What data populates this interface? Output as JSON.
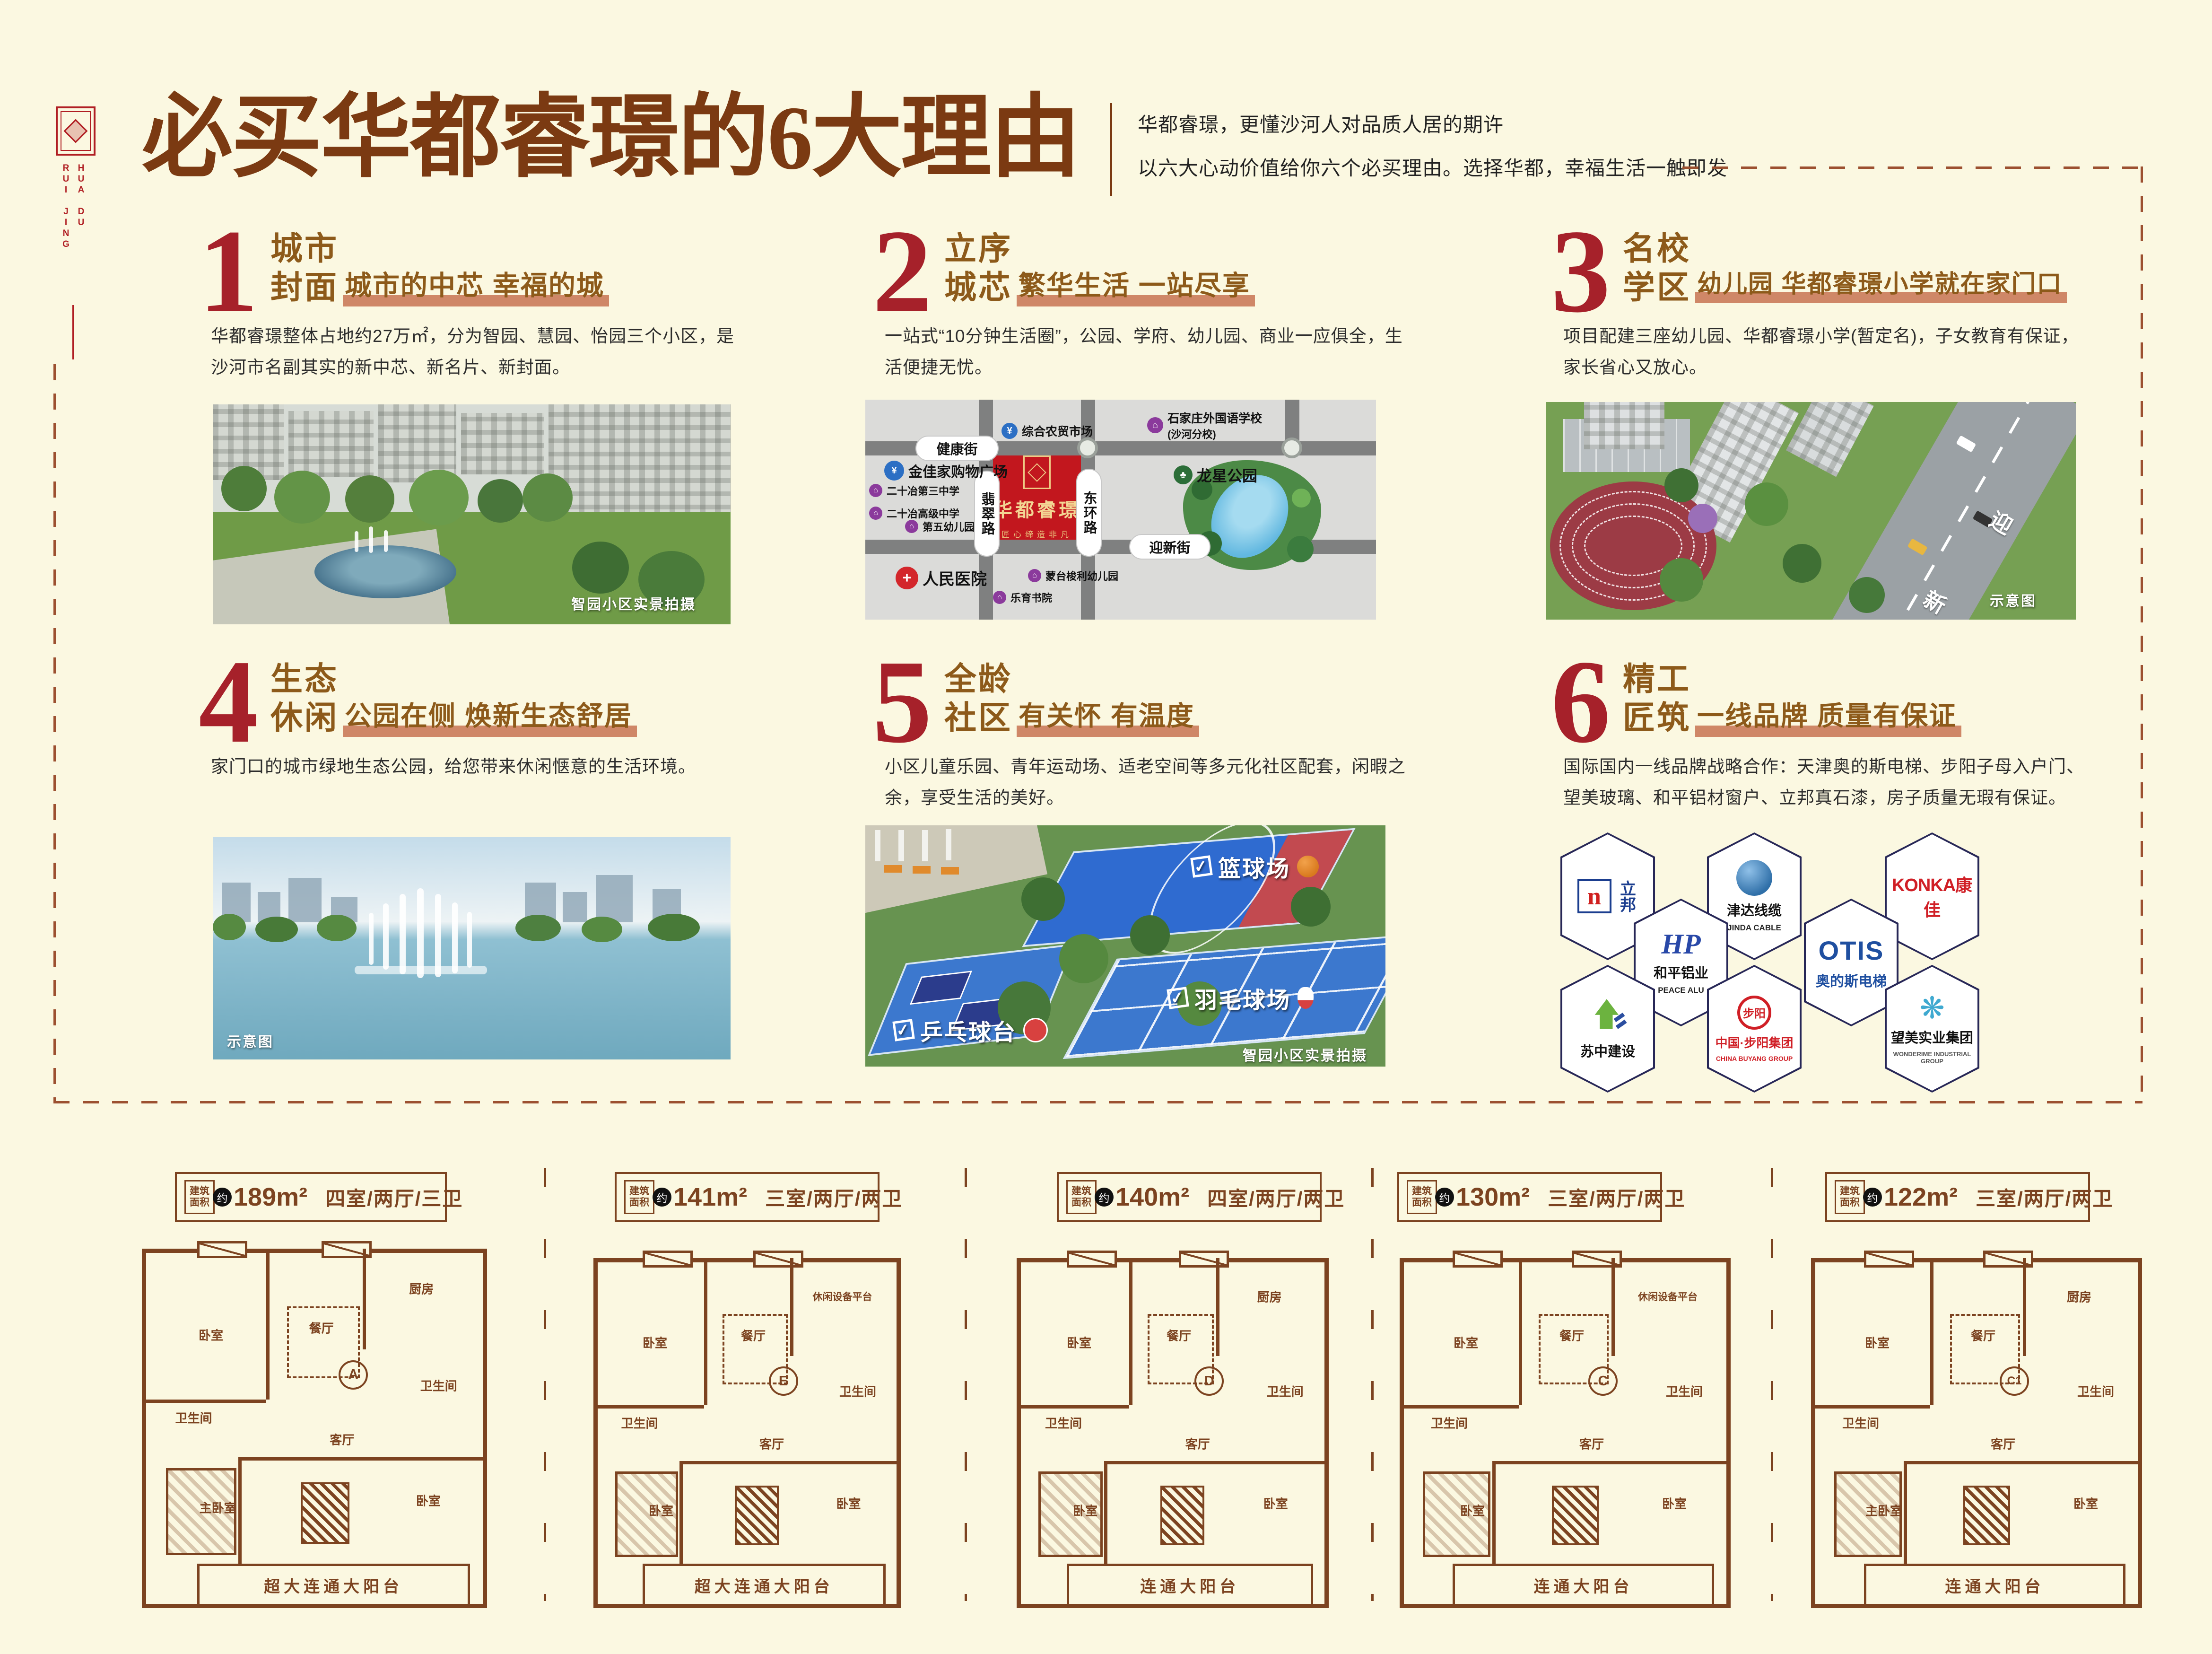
{
  "page": {
    "bg": "#FBF8E1"
  },
  "logo": {
    "col1": "HUA DU",
    "col2": "RUI JING"
  },
  "header": {
    "title": "必买华都睿璟的6大理由",
    "sub1": "华都睿璟，更懂沙河人对品质人居的期许",
    "sub2": "以六大心动价值给你六个必买理由。选择华都，幸福生活一触即发"
  },
  "colors": {
    "crimson": "#A6212A",
    "brown_title": "#8D5A1A",
    "dark_brown": "#7B3A12",
    "tag_bar": "#CF8767",
    "plan_brown": "#7C4320",
    "map_red": "#C2171E",
    "gold": "#F3D694"
  },
  "sections": [
    {
      "num": "1",
      "t1": "城市",
      "t2": "封面",
      "tag": "城市的中芯 幸福的城",
      "body": "华都睿璟整体占地约27万㎡，分为智园、慧园、怡园三个小区，是沙河市名副其实的新中芯、新名片、新封面。",
      "caption": "智园小区实景拍摄"
    },
    {
      "num": "2",
      "t1": "立序",
      "t2": "城芯",
      "tag": "繁华生活 一站尽享",
      "body": "一站式“10分钟生活圈”，公园、学府、幼儿园、商业一应俱全，生活便捷无忧。"
    },
    {
      "num": "3",
      "t1": "名校",
      "t2": "学区",
      "tag": "幼儿园 华都睿璟小学就在家门口",
      "body": "项目配建三座幼儿园、华都睿璟小学(暂定名)，子女教育有保证，家长省心又放心。",
      "caption": "示意图",
      "road1": "迎",
      "road2": "新"
    },
    {
      "num": "4",
      "t1": "生态",
      "t2": "休闲",
      "tag": "公园在侧 焕新生态舒居",
      "body": "家门口的城市绿地生态公园，给您带来休闲惬意的生活环境。",
      "caption": "示意图"
    },
    {
      "num": "5",
      "t1": "全龄",
      "t2": "社区",
      "tag": "有关怀 有温度",
      "body": "小区儿童乐园、青年运动场、适老空间等多元化社区配套，闲暇之余，享受生活的美好。",
      "caption": "智园小区实景拍摄",
      "badges": {
        "check": "✓",
        "b1": "篮球场",
        "b2": "羽毛球场",
        "b3": "乒乓球台"
      }
    },
    {
      "num": "6",
      "t1": "精工",
      "t2": "匠筑",
      "tag": "一线品牌 质量有保证",
      "body": "国际国内一线品牌战略合作：天津奥的斯电梯、步阳子母入户门、望美玻璃、和平铝材窗户、立邦真石漆，房子质量无瑕有保证。"
    }
  ],
  "map": {
    "roads": {
      "h_top": "健康街",
      "h_bottom": "迎新街",
      "v_left": "翡翠路",
      "v_right": "东环路"
    },
    "project": {
      "name": "华都睿璟",
      "slogan": "匠心缔造非凡"
    },
    "pois": {
      "market": "综合农贸市场",
      "school_fl1": "石家庄外国语学校",
      "school_fl2": "(沙河分校)",
      "mall": "金佳家购物广场",
      "school3": "二十冶第三中学",
      "school_senior": "二十冶高级中学",
      "kindergarten5": "第五幼儿园",
      "park": "龙星公园",
      "hospital": "人民医院",
      "montessori": "蒙台梭利幼儿园",
      "academy": "乐育书院"
    },
    "icons": {
      "home": "⌂",
      "yen": "¥",
      "cross": "+",
      "tree": "♣"
    }
  },
  "brands": {
    "nippon": {
      "mark": "n",
      "cn": "立邦"
    },
    "jinda": {
      "cn": "津达线缆",
      "en": "JINDA CABLE"
    },
    "konka": {
      "en": "KONKA",
      "cn": "康佳"
    },
    "peace": {
      "mark": "HP",
      "reg": "®",
      "cn": "和平铝业",
      "en": "PEACE ALU"
    },
    "otis": {
      "en": "OTIS",
      "cn": "奥的斯电梯"
    },
    "suzhong": {
      "cn": "苏中建设"
    },
    "buyang": {
      "mark": "步阳",
      "cn": "中国·步阳集团",
      "en": "CHINA BUYANG GROUP"
    },
    "wonderime": {
      "mark": "❋",
      "cn": "望美实业集团",
      "en": "WONDERIME INDUSTRIAL GROUP"
    }
  },
  "plans": {
    "badge1": "建筑",
    "badge2": "面积",
    "approx": "约",
    "items": [
      {
        "area": "189m²",
        "layout": "四室/两厅/三卫",
        "letter": "A",
        "balcony": "超大连通大阳台",
        "rooms": [
          "卧室",
          "餐厅",
          "厨房",
          "卫生间",
          "主卧室",
          "客厅",
          "卧室",
          "卫生间"
        ]
      },
      {
        "area": "141m²",
        "layout": "三室/两厅/两卫",
        "letter": "E",
        "balcony": "超大连通大阳台",
        "rooms": [
          "卧室",
          "餐厅",
          "休闲设备平台",
          "卫生间",
          "卧室",
          "客厅",
          "卧室",
          "卫生间"
        ]
      },
      {
        "area": "140m²",
        "layout": "四室/两厅/两卫",
        "letter": "D",
        "balcony": "连通大阳台",
        "rooms": [
          "卧室",
          "餐厅",
          "厨房",
          "卫生间",
          "卧室",
          "客厅",
          "卧室",
          "卫生间"
        ]
      },
      {
        "area": "130m²",
        "layout": "三室/两厅/两卫",
        "letter": "C",
        "balcony": "连通大阳台",
        "rooms": [
          "卧室",
          "餐厅",
          "休闲设备平台",
          "卫生间",
          "卧室",
          "客厅",
          "卧室",
          "卫生间"
        ]
      },
      {
        "area": "122m²",
        "layout": "三室/两厅/两卫",
        "letter": "C1",
        "balcony": "连通大阳台",
        "rooms": [
          "卧室",
          "餐厅",
          "厨房",
          "卫生间",
          "主卧室",
          "客厅",
          "卧室",
          "卫生间"
        ]
      }
    ]
  }
}
